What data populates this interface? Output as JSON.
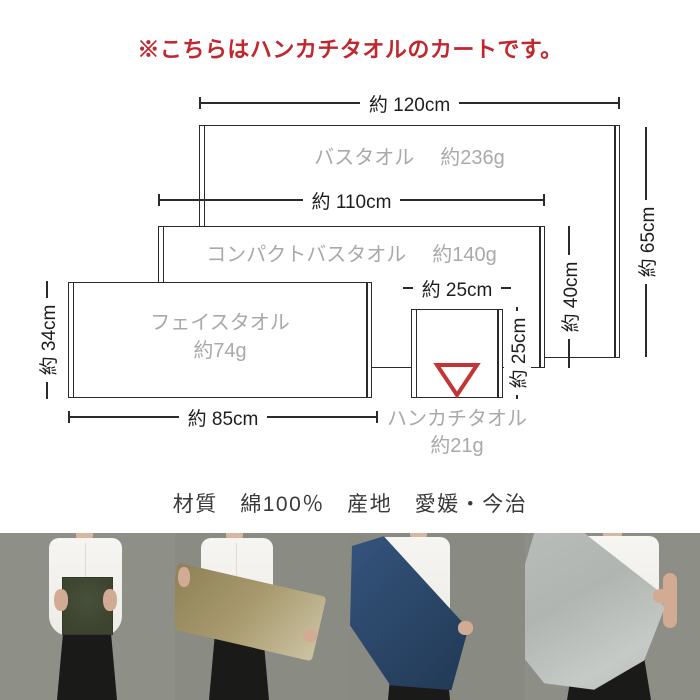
{
  "notice": {
    "text": "※こちらはハンカチタオルのカートです。",
    "color": "#c1272d"
  },
  "diagram": {
    "towels": [
      {
        "name": "バスタオル",
        "weight": "約236g",
        "width": "約 120cm",
        "height": "約 65cm"
      },
      {
        "name": "コンパクトバスタオル",
        "weight": "約140g",
        "width": "約 110cm",
        "height": "約 40cm"
      },
      {
        "name": "フェイスタオル",
        "weight": "約74g",
        "width": "約 85cm",
        "height": "約 34cm"
      },
      {
        "name": "ハンカチタオル",
        "weight": "約21g",
        "width": "約 25cm",
        "height": "約 25cm"
      }
    ],
    "marker": {
      "shape": "triangle-down-outline",
      "color": "#c43434"
    },
    "colors": {
      "line": "#2b2b2b",
      "towel_label": "#a9a9a9",
      "dimension_text": "#1e1e1e"
    }
  },
  "specs": {
    "text": "材質　綿100％　産地　愛媛・今治"
  },
  "photos": {
    "background": "#8b8e86",
    "items": [
      {
        "towel": "handkerchief-towel",
        "towel_color": "#3e4431"
      },
      {
        "towel": "face-towel",
        "towel_color": "#a89a6e"
      },
      {
        "towel": "compact-bath-towel",
        "towel_color": "#2b4769"
      },
      {
        "towel": "bath-towel",
        "towel_color": "#b5b9b5"
      }
    ]
  }
}
